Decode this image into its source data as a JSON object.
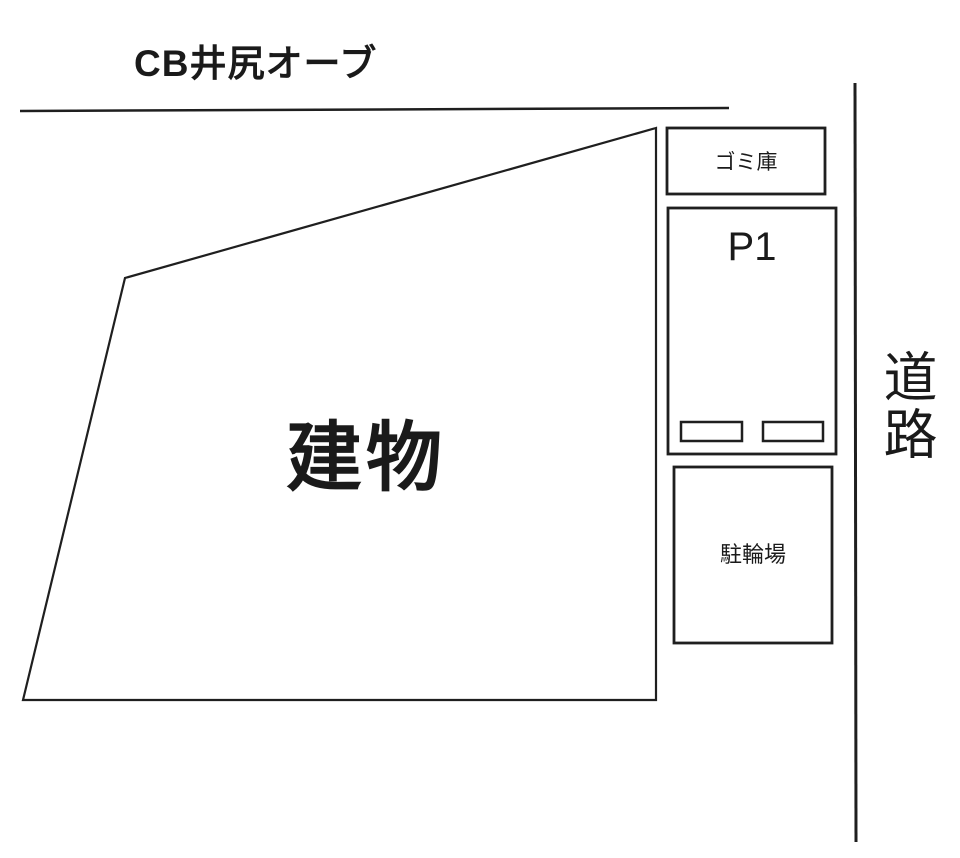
{
  "diagram": {
    "title": "CB井尻オーブ",
    "building": {
      "label": "建物"
    },
    "garbage": {
      "label": "ゴミ庫"
    },
    "parking": {
      "label": "P1"
    },
    "bicycle": {
      "label": "駐輪場"
    },
    "road": {
      "label": "道路"
    },
    "colors": {
      "line": "#1f1f1f",
      "background": "#ffffff",
      "text": "#1a1a1a"
    }
  }
}
